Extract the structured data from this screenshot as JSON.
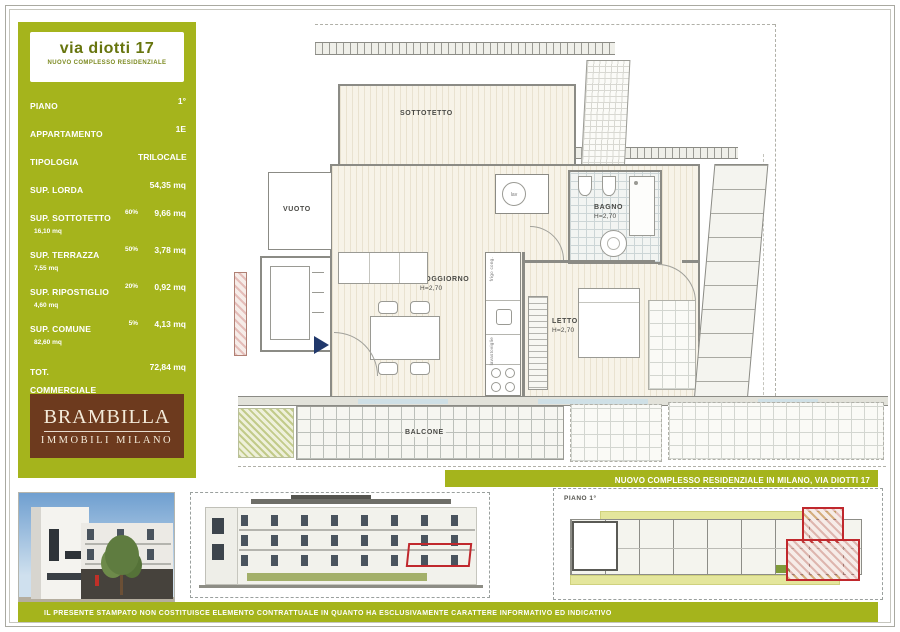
{
  "colors": {
    "accent_green": "#a5b41c",
    "logo_brown": "#6d3a1e",
    "highlight_red": "#c0282d",
    "arrow_navy": "#20386b"
  },
  "header": {
    "title": "via diotti 17",
    "subtitle": "NUOVO COMPLESSO RESIDENZIALE"
  },
  "sidebar": {
    "rows": [
      {
        "label": "PIANO",
        "sub": "",
        "pct": "",
        "value": "1°"
      },
      {
        "label": "APPARTAMENTO",
        "sub": "",
        "pct": "",
        "value": "1E"
      },
      {
        "label": "TIPOLOGIA",
        "sub": "",
        "pct": "",
        "value": "TRILOCALE"
      },
      {
        "label": "SUP. LORDA",
        "sub": "",
        "pct": "",
        "value": "54,35 mq"
      },
      {
        "label": "SUP. SOTTOTETTO",
        "sub": "16,10 mq",
        "pct": "60%",
        "value": "9,66 mq"
      },
      {
        "label": "SUP. TERRAZZA",
        "sub": "7,55 mq",
        "pct": "50%",
        "value": "3,78 mq"
      },
      {
        "label": "SUP. RIPOSTIGLIO",
        "sub": "4,60 mq",
        "pct": "20%",
        "value": "0,92 mq"
      },
      {
        "label": "SUP. COMUNE",
        "sub": "82,60 mq",
        "pct": "5%",
        "value": "4,13 mq"
      },
      {
        "label": "TOT. COMMERCIALE",
        "sub": "",
        "pct": "",
        "value": "72,84 mq"
      }
    ]
  },
  "logo": {
    "name": "BRAMBILLA",
    "tagline": "IMMOBILI MILANO"
  },
  "plan": {
    "rooms": {
      "sottotetto": "SOTTOTETTO",
      "vuoto": "VUOTO",
      "soggiorno": "SOGGIORNO",
      "soggiorno_h": "H=2,70",
      "bagno": "BAGNO",
      "bagno_h": "H=2,70",
      "letto": "LETTO",
      "letto_h": "H=2,70",
      "lav": "lav",
      "balcone": "BALCONE"
    },
    "labels": {
      "frigo": "frigo cong.",
      "lavastoviglie": "lavastoviglie"
    }
  },
  "banner": {
    "text": "NUOVO COMPLESSO RESIDENZIALE IN MILANO, VIA DIOTTI 17"
  },
  "keyplan": {
    "label": "PIANO 1°"
  },
  "footer": {
    "disclaimer": "IL PRESENTE STAMPATO NON COSTITUISCE ELEMENTO CONTRATTUALE IN QUANTO HA ESCLUSIVAMENTE CARATTERE INFORMATIVO ED INDICATIVO"
  }
}
